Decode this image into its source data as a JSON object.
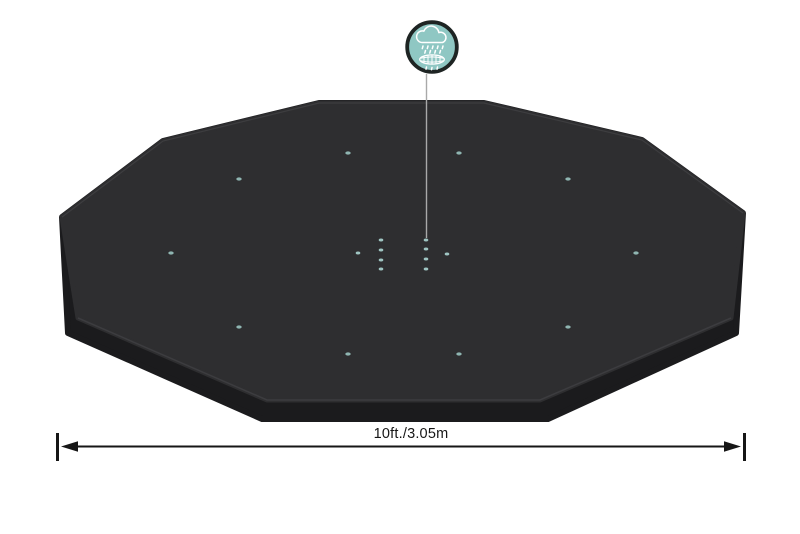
{
  "figure": {
    "dimension_label": "10ft./3.05m",
    "icon": {
      "name": "rain-drainage-icon",
      "fill_color": "#8FC7C3",
      "ring_color": "#1E2423",
      "glyph_color": "#FFFFFF"
    },
    "colors": {
      "background": "#FFFFFF",
      "cover_top": "#2E2E30",
      "cover_side": "#1B1B1D",
      "rim_highlight": "#454548",
      "seam_highlight": "#3E3E41",
      "grommet": "#8FB5B1",
      "drain_dot": "#9FC5C2",
      "pointer_line": "#A9A9A9",
      "dimension": "#161616"
    },
    "grommets": [
      [
        348,
        153
      ],
      [
        459,
        153
      ],
      [
        239,
        179
      ],
      [
        568,
        179
      ],
      [
        171,
        253
      ],
      [
        636,
        253
      ],
      [
        239,
        327
      ],
      [
        568,
        327
      ],
      [
        348,
        354
      ],
      [
        459,
        354
      ]
    ],
    "drain_dots": [
      [
        381,
        240
      ],
      [
        381,
        250
      ],
      [
        381,
        260
      ],
      [
        381,
        269
      ],
      [
        426,
        240
      ],
      [
        426,
        249
      ],
      [
        426,
        259
      ],
      [
        426,
        269
      ],
      [
        358,
        253
      ],
      [
        447,
        254
      ]
    ]
  }
}
